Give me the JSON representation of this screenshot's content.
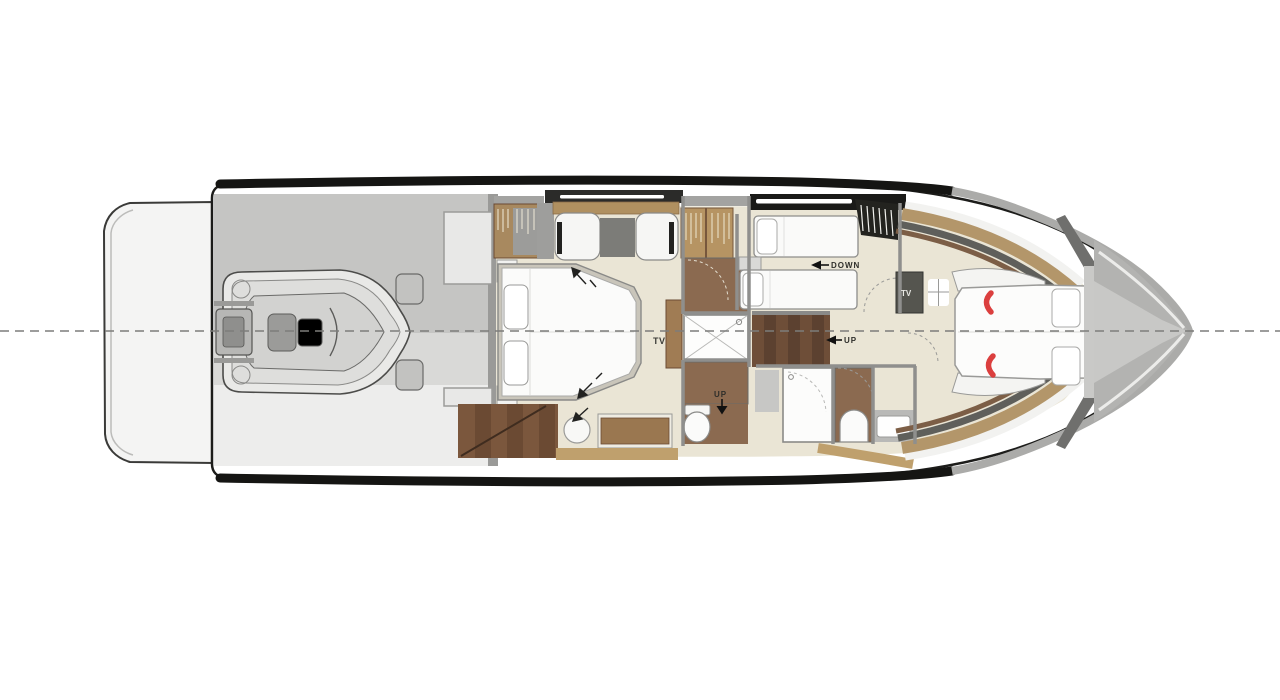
{
  "plan": {
    "labels": {
      "master_tv": "TV",
      "foyer_tv": "TV",
      "stairs_down": "DOWN",
      "stairs_up": "UP",
      "head_up": "UP"
    },
    "icons": {
      "left_arrow": "◀",
      "down_arrow": "▼"
    },
    "palette": {
      "background": "#ffffff",
      "centerline_gray": "#7d7d7b",
      "hull_black": "#151513",
      "wall_gray": "#9a9a98",
      "garage_gray": "#c5c5c3",
      "floor_beige": "#eae5d5",
      "wood_tan": "#b3966a",
      "wood_mid": "#8b6a50",
      "wood_dark": "#6b4a33",
      "furniture_white": "#fbfbfa",
      "accent_red": "#db3f3e"
    }
  }
}
